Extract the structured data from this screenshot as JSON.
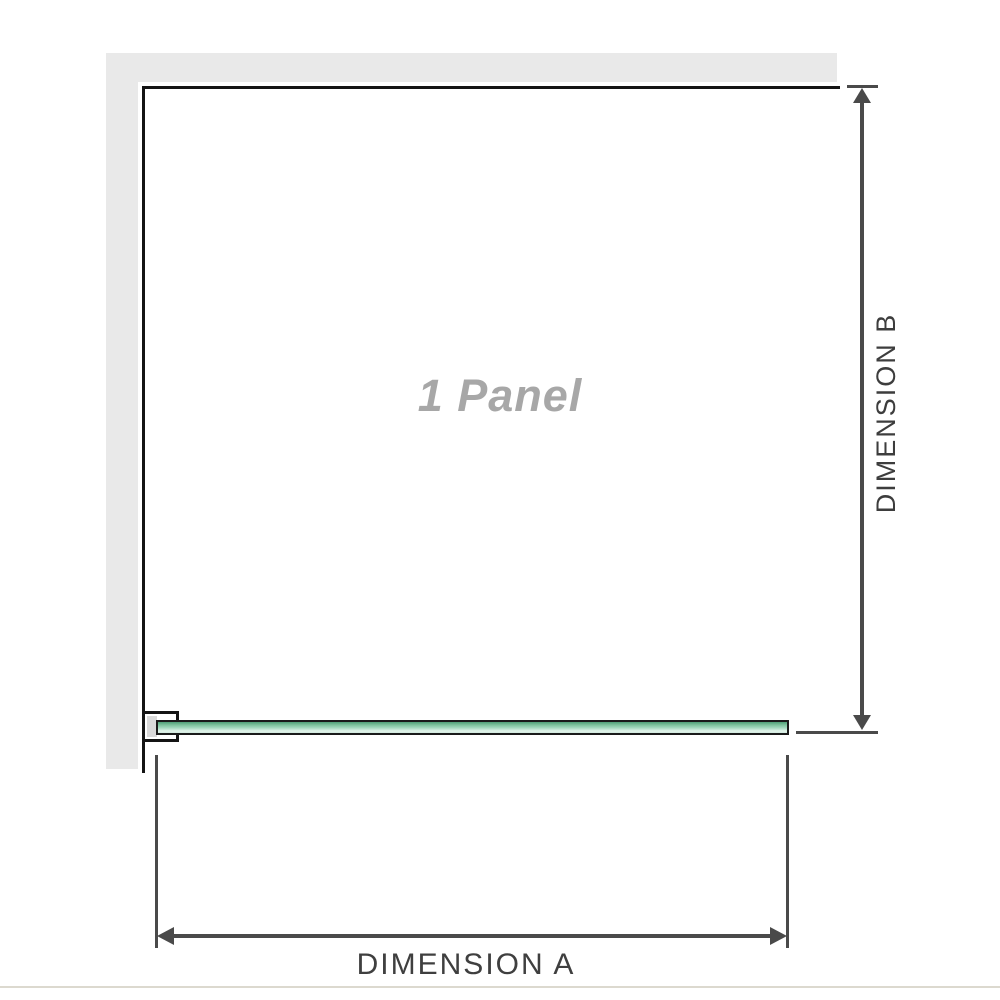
{
  "diagram": {
    "title_label": "1 Panel",
    "dimension_a_label": "DIMENSION A",
    "dimension_b_label": "DIMENSION B"
  },
  "colors": {
    "wall": "#e9e9e9",
    "edge": "#141414",
    "dimension": "#4a4a4a",
    "glass_border": "#1a1a1a",
    "glass_top": "#4f9f77",
    "glass_mid": "#9ed7bb",
    "glass_light": "#e2f3ea",
    "panel_text": "#a7a7a7",
    "baseline": "#dcd9cf"
  }
}
